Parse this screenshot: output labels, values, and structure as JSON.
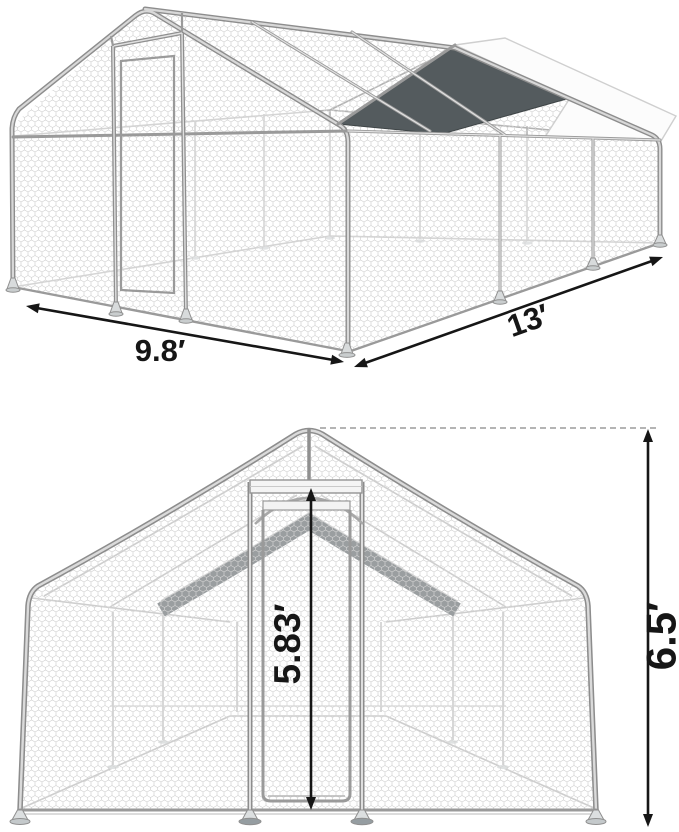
{
  "diagram": {
    "subject": "Walk-in galvanized metal chicken run with wire mesh walls, peaked roof and partial roof covers, shown in two dimensioned views",
    "views": [
      {
        "id": "isometric",
        "name": "perspective view",
        "dimensions": {
          "width": "9.8′",
          "length": "13′"
        }
      },
      {
        "id": "front",
        "name": "front elevation view",
        "dimensions": {
          "door_height": "5.83′",
          "total_height": "6.5′"
        }
      }
    ],
    "colors": {
      "frame": "#8d8d8d",
      "frame_highlight": "#d8d8d8",
      "mesh_line": "#d2d2d2",
      "roof_cover_dark": "#545b5e",
      "roof_cover_light": "#fcfcfc",
      "dimension": "#161616",
      "background": "#ffffff"
    }
  }
}
